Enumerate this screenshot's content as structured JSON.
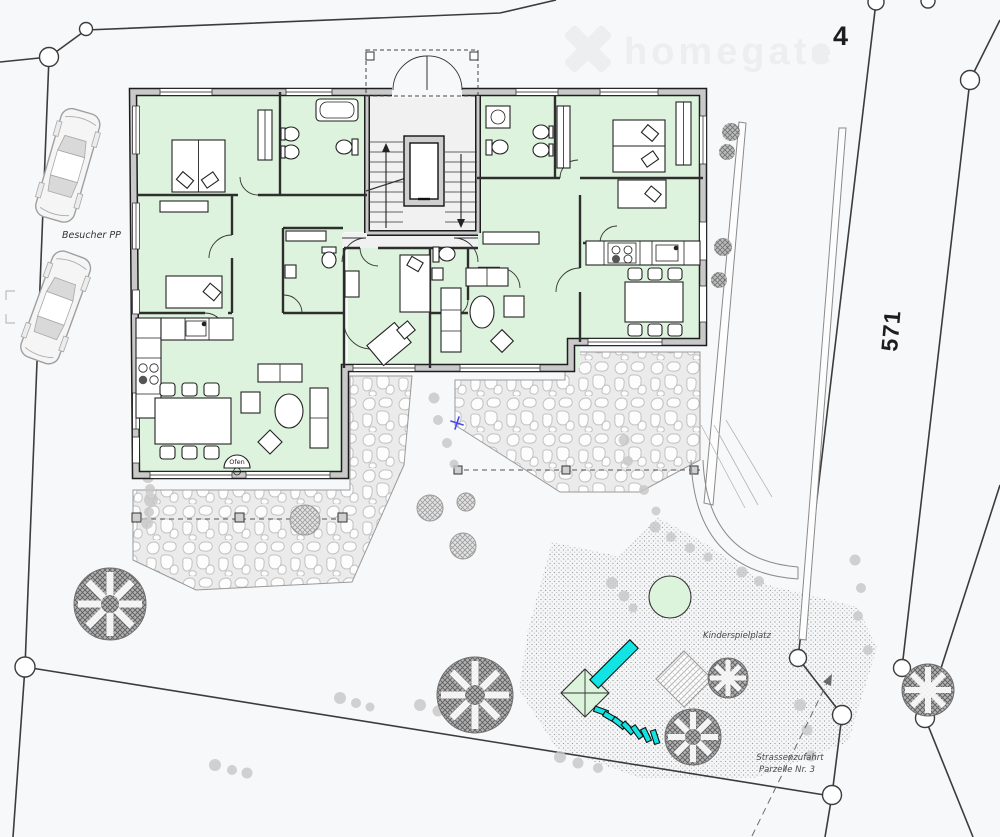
{
  "site_plan": {
    "parcel_labels": {
      "building_parcel": "4",
      "road_parcel": "571"
    },
    "annotations": {
      "visitor_parking": "Besucher PP",
      "playground": "Kinderspielplatz",
      "street_access_line1": "Strassenzufahrt",
      "street_access_line2": "Parzelle Nr. 3",
      "oven": "Ofen"
    },
    "watermark": {
      "brand": "homegate"
    },
    "colors": {
      "background": "#f7f8f9",
      "room_green": "#ddf3dd",
      "playground_green": "#dcf3dc",
      "wall_gray": "#c9c9c9",
      "boundary": "#3c3c3c",
      "cyan": "#12e4e4",
      "watermark": "#eceef0",
      "survey_cross_blue": "#4a4aee"
    }
  }
}
